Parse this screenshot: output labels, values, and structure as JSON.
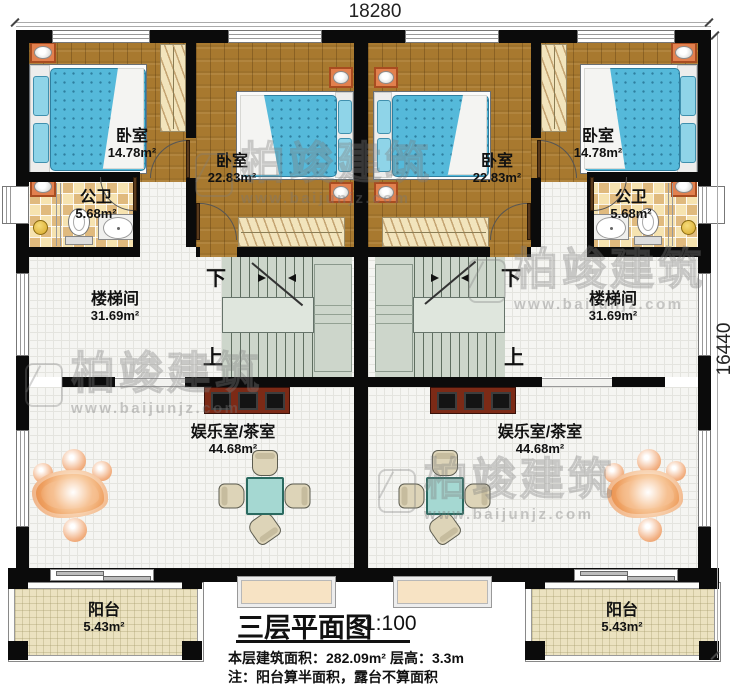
{
  "dimensions": {
    "width_label": "18280",
    "height_label": "16440"
  },
  "rooms": {
    "bedroom_small": {
      "name": "卧室",
      "area": "14.78m²"
    },
    "bedroom_large": {
      "name": "卧室",
      "area": "22.83m²"
    },
    "bathroom": {
      "name": "公卫",
      "area": "5.68m²"
    },
    "stairwell": {
      "name": "楼梯间",
      "area": "31.69m²"
    },
    "entertainment": {
      "name": "娱乐室/茶室",
      "area": "44.68m²"
    },
    "balcony": {
      "name": "阳台",
      "area": "5.43m²"
    }
  },
  "stairs": {
    "down_label": "下",
    "up_label": "上"
  },
  "title_block": {
    "title": "三层平面图",
    "scale": "1:100",
    "area_text": "本层建筑面积：282.09m²",
    "height_text": "层高：3.3m",
    "note_text": "注：阳台算半面积，露台不算面积"
  },
  "watermark": {
    "brand": "柏竣建筑",
    "site": "www.baijunjz.com"
  },
  "colors": {
    "wall": "#0b0b0b",
    "wood_floor": "#a8792f",
    "mattress": "#55b9da",
    "stair_floor": "#cdd6cb",
    "balcony_floor": "#ebe2c0",
    "nightstand": "#e2804e",
    "tv_cabinet": "#7c2a16",
    "tea_table": "#a5d8d2",
    "rock": "#ee9e5e"
  }
}
